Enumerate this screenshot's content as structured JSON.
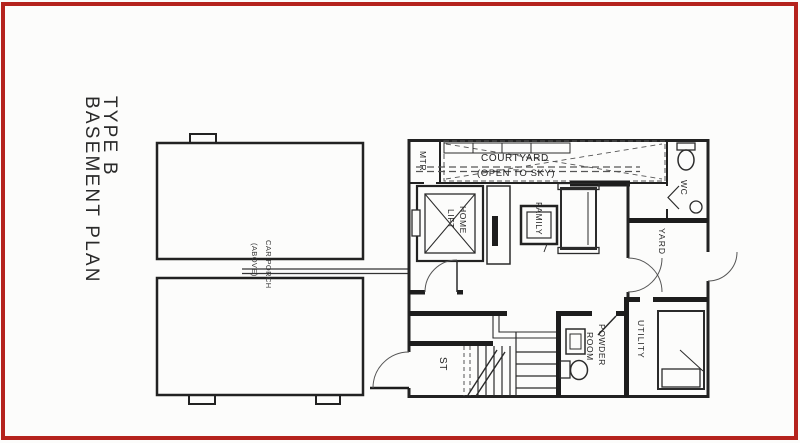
{
  "page": {
    "frame_color": "#b5231d",
    "ink_color": "#222222",
    "background": "#fcfcfb"
  },
  "title": {
    "line1": "TYPE B",
    "line2": "BASEMENT PLAN"
  },
  "left_block": {
    "label_line1": "CAR PORCH",
    "label_line2": "(ABOVE)"
  },
  "rooms": {
    "mtr": "MTR",
    "courtyard_line1": "COURTYARD",
    "courtyard_line2": "(OPEN TO SKY)",
    "wc": "WC",
    "yard": "YARD",
    "home_lift_line1": "HOME",
    "home_lift_line2": "LIFT",
    "family": "FAMILY",
    "stairs": "ST",
    "powder_line1": "POWDER",
    "powder_line2": "ROOM",
    "utility": "UTILITY"
  }
}
